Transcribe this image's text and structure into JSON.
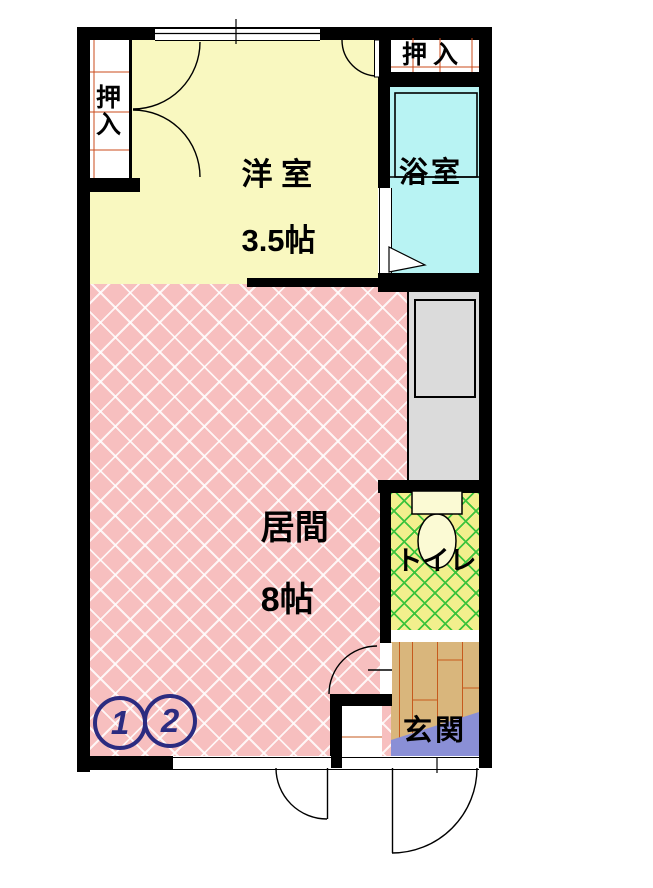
{
  "floor_plan": {
    "wall_color": "#000000",
    "rooms": {
      "western_room": {
        "label": "洋 室",
        "size": "3.5帖",
        "color": "#f9f8c0"
      },
      "living_room": {
        "label": "居間",
        "size": "8帖",
        "color": "#f7bfbf"
      },
      "bathroom": {
        "label": "浴室",
        "color": "#b8f3f3"
      },
      "toilet": {
        "label": "トイレ",
        "color": "#f2ef8d",
        "hatch_color": "#3cc33c"
      },
      "entrance": {
        "label": "玄関",
        "floor_color": "#d9b67c",
        "step_color": "#8a8fd6"
      }
    },
    "closets": {
      "left": {
        "label": "押入"
      },
      "top_right": {
        "label": "押入"
      }
    },
    "unit_markers": {
      "values": [
        "1",
        "2"
      ],
      "color": "#2b2b80"
    }
  }
}
